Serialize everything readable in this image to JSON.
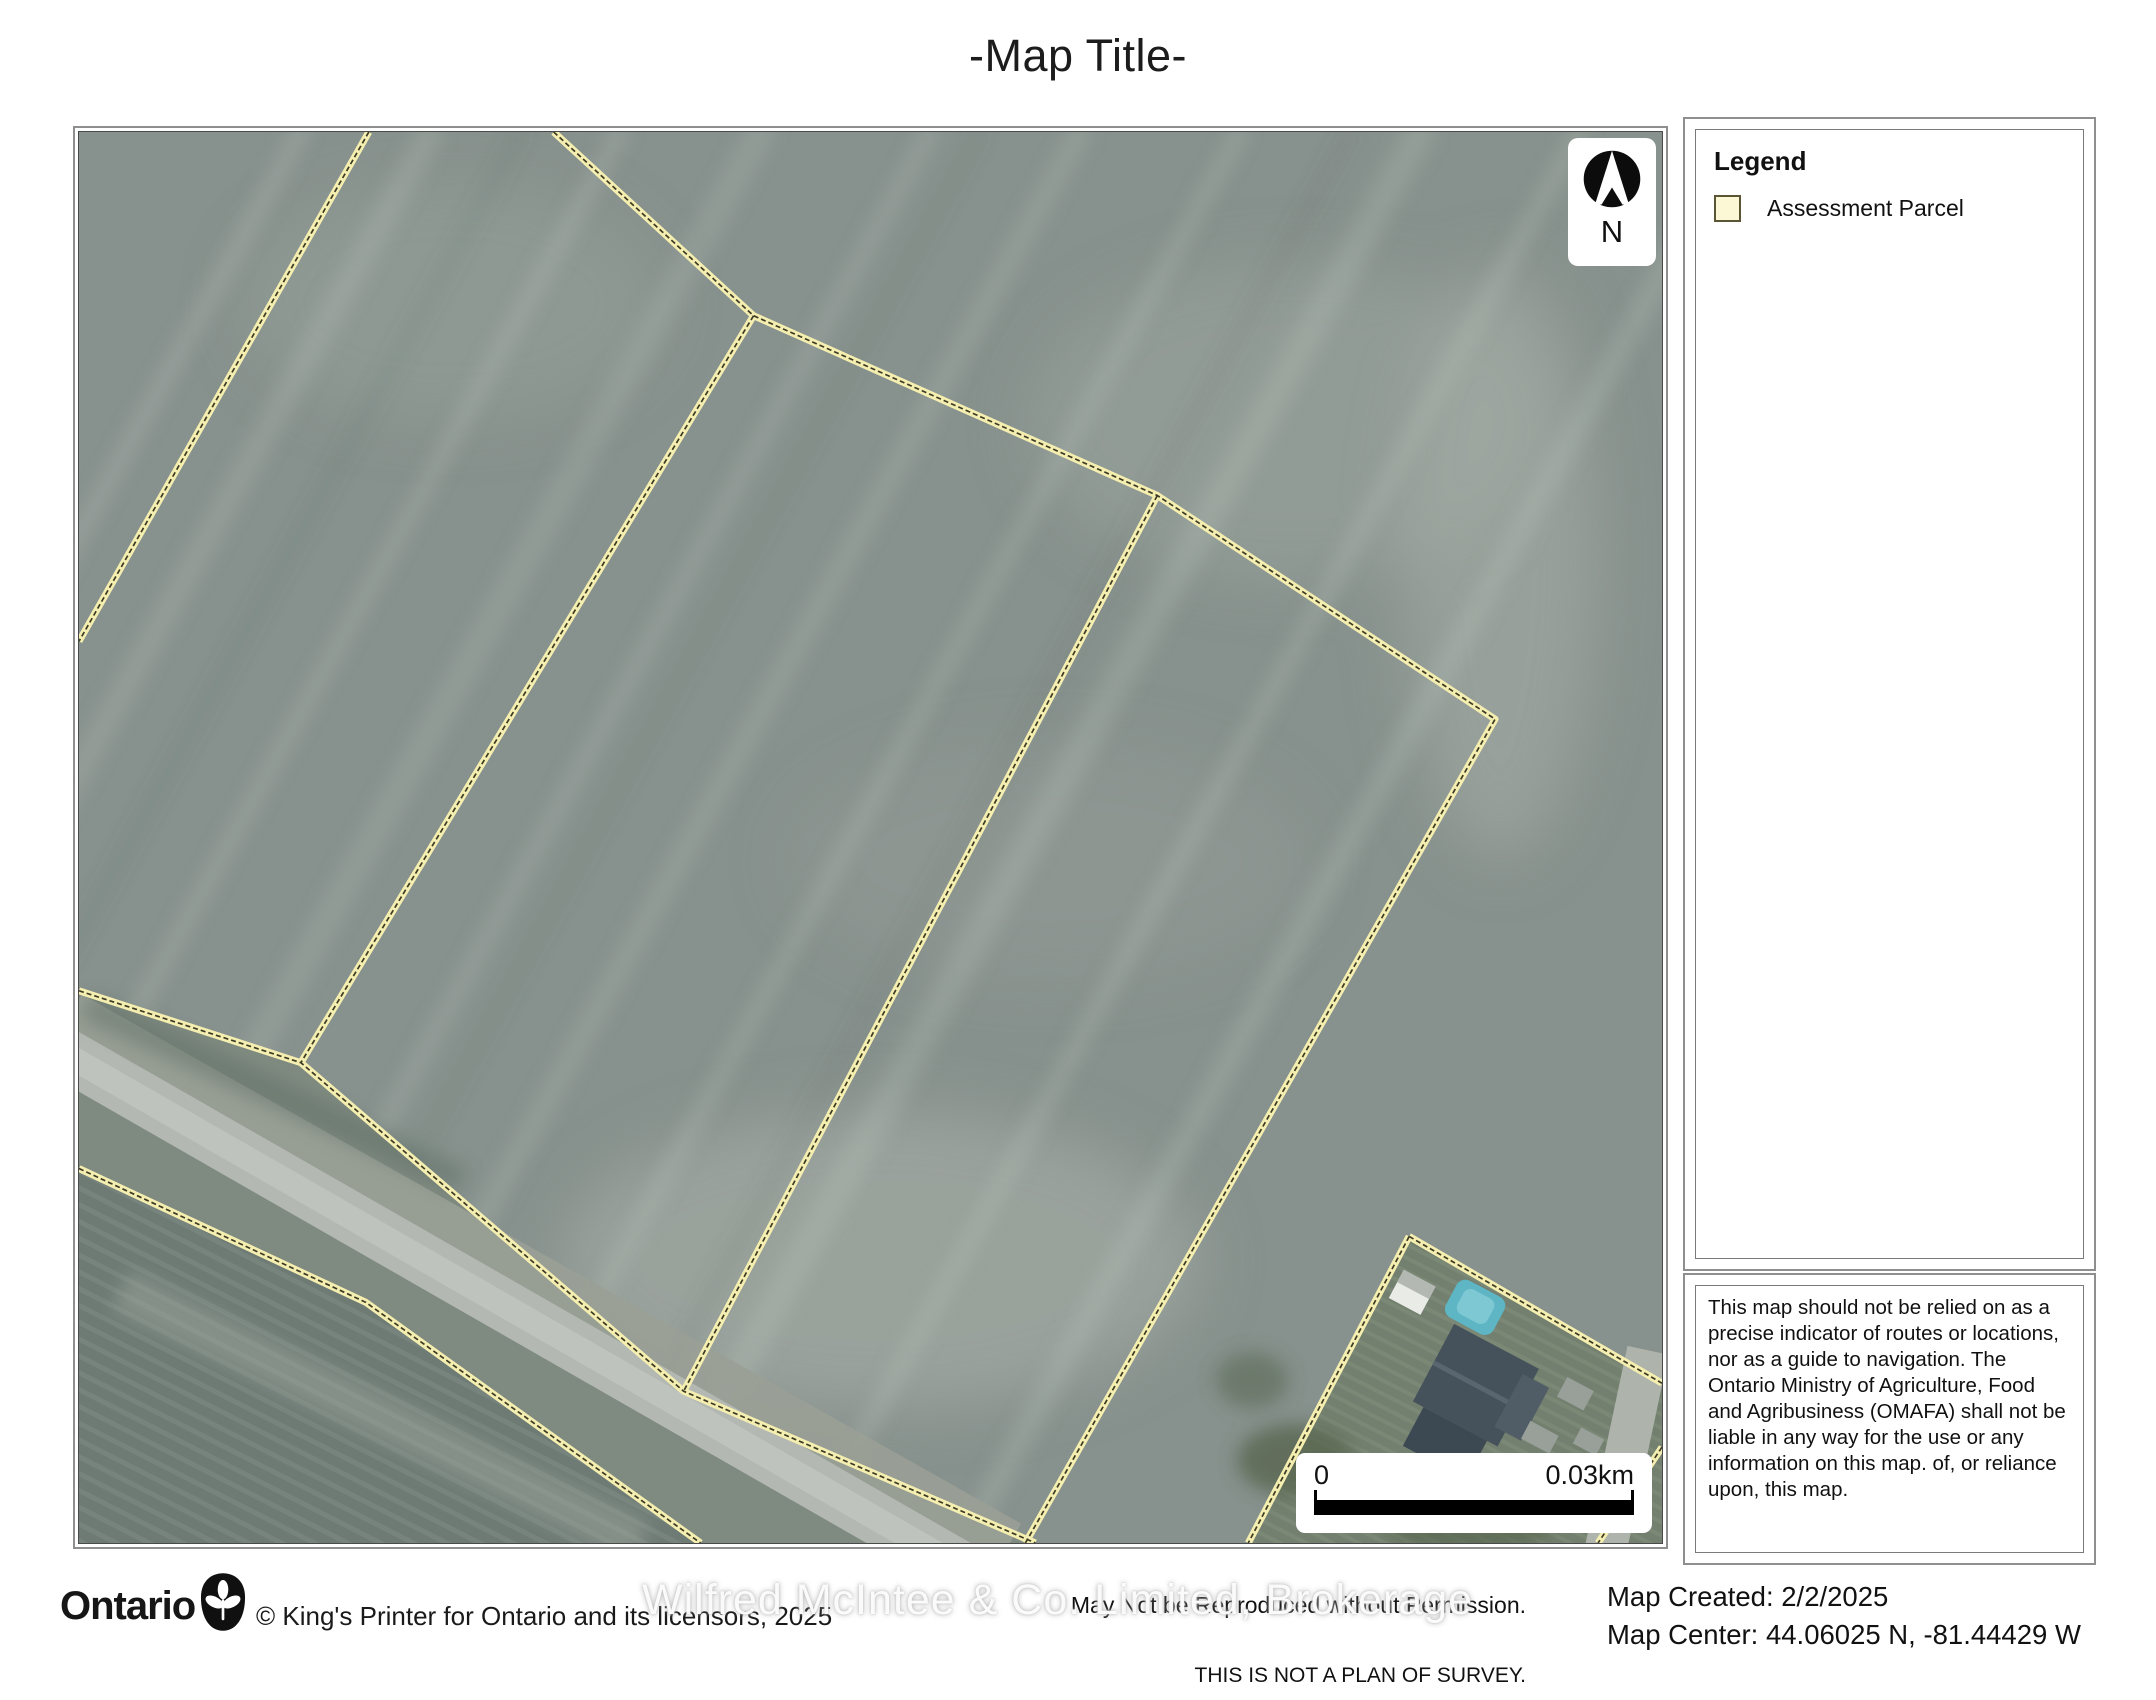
{
  "page_title": "-Map Title-",
  "map": {
    "north_arrow_label": "N",
    "scale_bar": {
      "start_label": "0",
      "end_label": "0.03km"
    }
  },
  "legend": {
    "heading": "Legend",
    "items": [
      {
        "label": "Assessment Parcel",
        "swatch_fill": "#fcf8d6",
        "swatch_border": "#5a5635"
      }
    ]
  },
  "disclaimer": "This map should not be relied on as a precise indicator of routes or locations, nor as a guide to navigation. The Ontario Ministry of Agriculture, Food and Agribusiness (OMAFA) shall not be liable in any way for the use or any information on this map. of, or reliance upon, this map.",
  "footer": {
    "logo_text": "Ontario",
    "copyright": "© King's Printer for Ontario and its licensors, 2025",
    "notice_line1": "May Not be Reproduced without Permission.",
    "notice_line2": "THIS IS NOT A PLAN OF SURVEY.",
    "map_created_label": "Map Created:",
    "map_created_value": "2/2/2025",
    "map_center_label": "Map Center:",
    "map_center_value": "44.06025 N, -81.44429 W",
    "watermark": "Wilfred McIntee & Co. Limited, Brokerage"
  },
  "icons": {
    "north_arrow": "compass-north-arrow",
    "trillium": "ontario-trillium-logo"
  },
  "colors": {
    "parcel_line_yellow": "#f4eeb0",
    "parcel_line_core": "#3c3a24",
    "field_base": "#87918d",
    "plowed_field": "#6e7b75",
    "road_pavement": "#b3b8b2",
    "pool_teal": "#5eb5c4",
    "roof_slate": "#45515b"
  }
}
